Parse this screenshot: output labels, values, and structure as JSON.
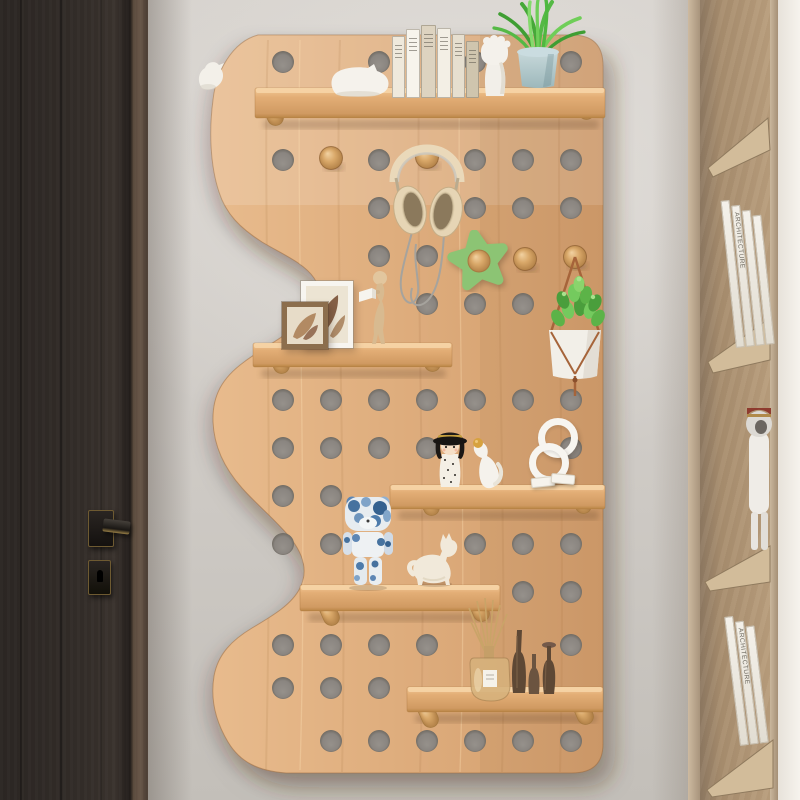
{
  "image": {
    "type": "product-photo",
    "subject": "Wavy-edged wooden pegboard wall shelf with decor, between a dark door and a wooden bookcase",
    "width": 800,
    "height": 800
  },
  "palette": {
    "wall": "#d0ccc7",
    "wall_shadow": "#bdb8b2",
    "door": "#332d29",
    "door_edge": "#6a584a",
    "handle_black": "#1b1815",
    "handle_brass": "#96793f",
    "board_wood": "#dfae7e",
    "board_wood_light": "#eabd8e",
    "board_wood_dark": "#d09c6a",
    "hole_gray": "#8a8580",
    "knob_wood": "#d4a266",
    "shelf_top": "#f4cf9f",
    "shelf_face": "#dca76f",
    "star_green": "#8cc474",
    "succulent_green": "#5cb348",
    "grass_green": "#4fb83f",
    "pot_blue_gray": "#b4c9cc",
    "headphone_cream": "#e7d6b6",
    "bearbrick_blue": "#4a76a8",
    "ceramic_white": "#f3efe7",
    "frame_brown": "#8c6e4d",
    "diffuser_amber": "#d4b07a",
    "vase_dark_brown": "#5e4835",
    "cabinet_back": "#ab9172",
    "cabinet_frame": "#c3af95",
    "cabinet_bright_wall": "#f3f0ea"
  },
  "pegboard": {
    "hole_radius": 11,
    "holes": [
      [
        283,
        62
      ],
      [
        379,
        62
      ],
      [
        475,
        62
      ],
      [
        571,
        62
      ],
      [
        283,
        160
      ],
      [
        379,
        160
      ],
      [
        475,
        160
      ],
      [
        523,
        160
      ],
      [
        571,
        160
      ],
      [
        379,
        208
      ],
      [
        475,
        208
      ],
      [
        523,
        208
      ],
      [
        571,
        208
      ],
      [
        379,
        256
      ],
      [
        427,
        256
      ],
      [
        427,
        304
      ],
      [
        475,
        304
      ],
      [
        523,
        304
      ],
      [
        283,
        400
      ],
      [
        331,
        400
      ],
      [
        379,
        400
      ],
      [
        427,
        400
      ],
      [
        475,
        400
      ],
      [
        523,
        400
      ],
      [
        571,
        400
      ],
      [
        283,
        448
      ],
      [
        331,
        448
      ],
      [
        379,
        448
      ],
      [
        427,
        448
      ],
      [
        571,
        448
      ],
      [
        283,
        496
      ],
      [
        331,
        496
      ],
      [
        283,
        544
      ],
      [
        331,
        544
      ],
      [
        475,
        544
      ],
      [
        523,
        544
      ],
      [
        571,
        544
      ],
      [
        523,
        592
      ],
      [
        571,
        592
      ],
      [
        283,
        645
      ],
      [
        331,
        645
      ],
      [
        379,
        645
      ],
      [
        427,
        645
      ],
      [
        571,
        645
      ],
      [
        283,
        688
      ],
      [
        331,
        688
      ],
      [
        379,
        688
      ],
      [
        331,
        741
      ],
      [
        379,
        741
      ],
      [
        427,
        741
      ],
      [
        475,
        741
      ],
      [
        523,
        741
      ],
      [
        571,
        741
      ]
    ],
    "pegs": [
      [
        331,
        158
      ],
      [
        427,
        157
      ],
      [
        525,
        259
      ],
      [
        575,
        257
      ]
    ],
    "shelves": [
      {
        "x": 255,
        "y": 88,
        "w": 350,
        "h": 30,
        "dowels": [
          [
            273,
            112
          ],
          [
            584,
            106
          ]
        ]
      },
      {
        "x": 253,
        "y": 343,
        "w": 199,
        "h": 24,
        "dowels": [
          [
            279,
            360
          ],
          [
            430,
            358
          ]
        ]
      },
      {
        "x": 390,
        "y": 485,
        "w": 215,
        "h": 24,
        "dowels": [
          [
            429,
            502
          ],
          [
            581,
            500
          ]
        ]
      },
      {
        "x": 300,
        "y": 585,
        "w": 200,
        "h": 26,
        "dowels": [
          [
            329,
            612
          ],
          [
            479,
            608
          ]
        ]
      },
      {
        "x": 407,
        "y": 687,
        "w": 196,
        "h": 25,
        "dowels": [
          [
            428,
            714
          ],
          [
            583,
            711
          ]
        ]
      }
    ]
  },
  "decor": {
    "books_top": {
      "spines": [
        {
          "w": 13,
          "h": 62,
          "color": "#efe9dc"
        },
        {
          "w": 14,
          "h": 69,
          "color": "#f7f4ec"
        },
        {
          "w": 15,
          "h": 73,
          "color": "#ddd3c0"
        },
        {
          "w": 14,
          "h": 70,
          "color": "#f3efe5"
        },
        {
          "w": 13,
          "h": 64,
          "color": "#e6dfcf"
        },
        {
          "w": 13,
          "h": 57,
          "color": "#cfc5ae"
        }
      ]
    },
    "items": [
      {
        "id": "edge-bird-figurine",
        "label": "small white bird on wavy edge"
      },
      {
        "id": "pig-bookend",
        "label": "white animal bookend"
      },
      {
        "id": "book-stack",
        "label": "row of books"
      },
      {
        "id": "fist-sculpture",
        "label": "white fist sculpture"
      },
      {
        "id": "grass-plant",
        "label": "potted grass plant in pale blue pot"
      },
      {
        "id": "headphones",
        "label": "cream headphones hanging on peg"
      },
      {
        "id": "star-hook",
        "label": "green star wall hook"
      },
      {
        "id": "wood-pegs",
        "label": "round wooden pegs"
      },
      {
        "id": "hanging-planter",
        "label": "succulent in white hanging pot"
      },
      {
        "id": "photo-frames",
        "label": "two leaning picture frames"
      },
      {
        "id": "reading-man-figurine",
        "label": "wooden man reading a book"
      },
      {
        "id": "doll-girl-figurine",
        "label": "wooden doll with black hat"
      },
      {
        "id": "squirrel-figurine",
        "label": "white figure holding golden acorn"
      },
      {
        "id": "white-rings",
        "label": "two white rings"
      },
      {
        "id": "white-blocks",
        "label": "small white blocks"
      },
      {
        "id": "bearbrick-figure",
        "label": "blue camo bear figure"
      },
      {
        "id": "cat-figurine",
        "label": "cream cat figurine"
      },
      {
        "id": "reed-diffuser",
        "label": "reed diffuser bottle with sticks"
      },
      {
        "id": "wooden-vases",
        "label": "three dark turned-wood vases"
      }
    ]
  },
  "cabinet": {
    "book_groups": [
      {
        "left": 81,
        "top": 200,
        "height": 148,
        "spines": 4,
        "lean": -6,
        "text": "ARCHITECTURE"
      },
      {
        "left": 85,
        "top": 616,
        "height": 130,
        "spines": 3,
        "lean": -7,
        "text": "ARCHITECTURE"
      }
    ],
    "figurine": {
      "id": "cabinet-cat-figure",
      "label": "white cat figure with dark red cap"
    }
  }
}
